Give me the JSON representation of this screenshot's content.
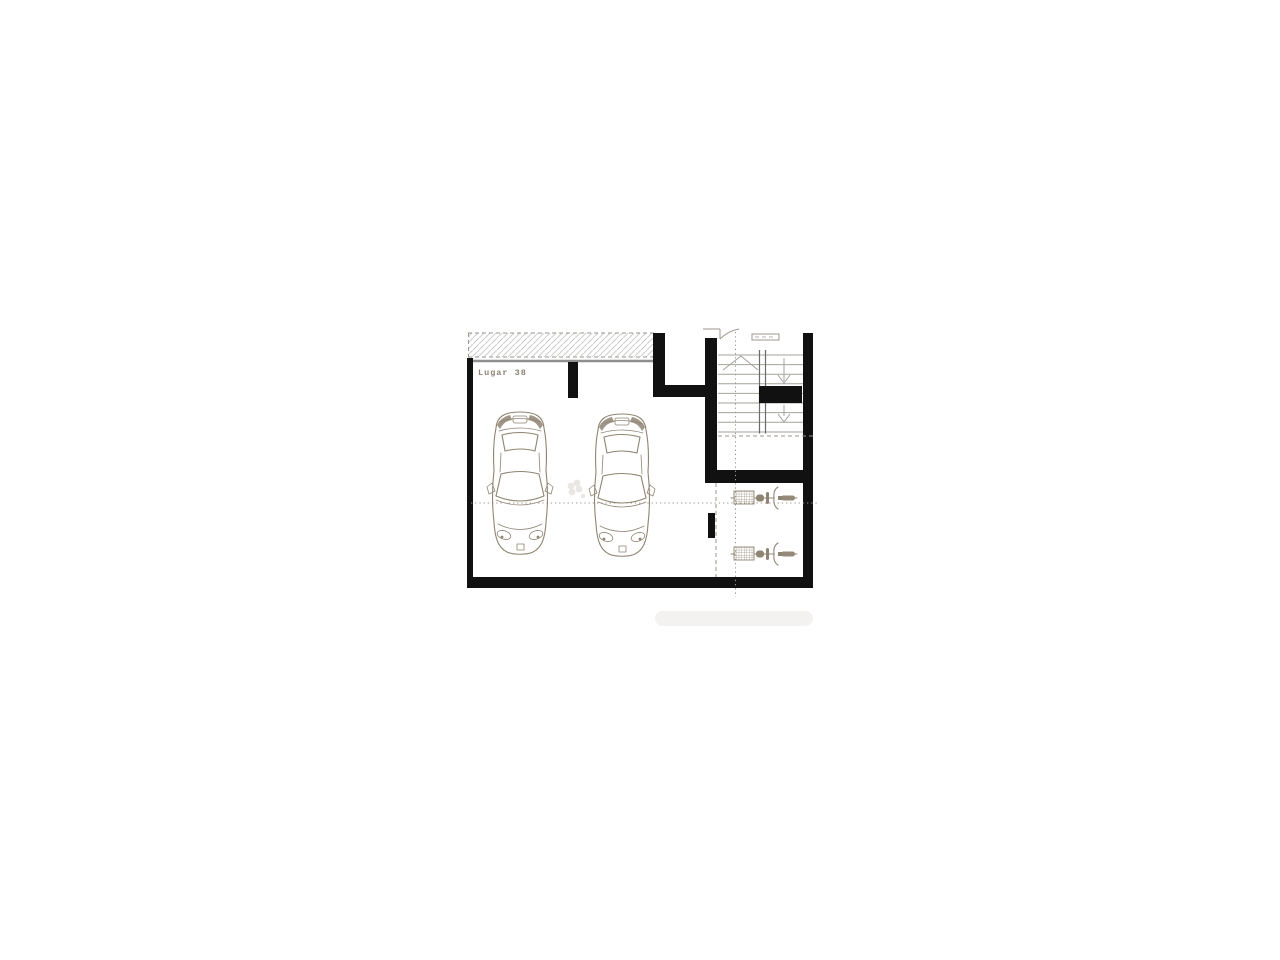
{
  "plan": {
    "label": "Lugar 38",
    "counts": {
      "cars": 2,
      "bicycles": 2,
      "staircases": 1
    },
    "colors": {
      "wall": "#111111",
      "line": "#8f8472",
      "stair": "#a6a29a",
      "guide": "#9c978e",
      "hatch": "#cccccc",
      "faint": "#e7e5e1",
      "background": "#ffffff"
    }
  }
}
